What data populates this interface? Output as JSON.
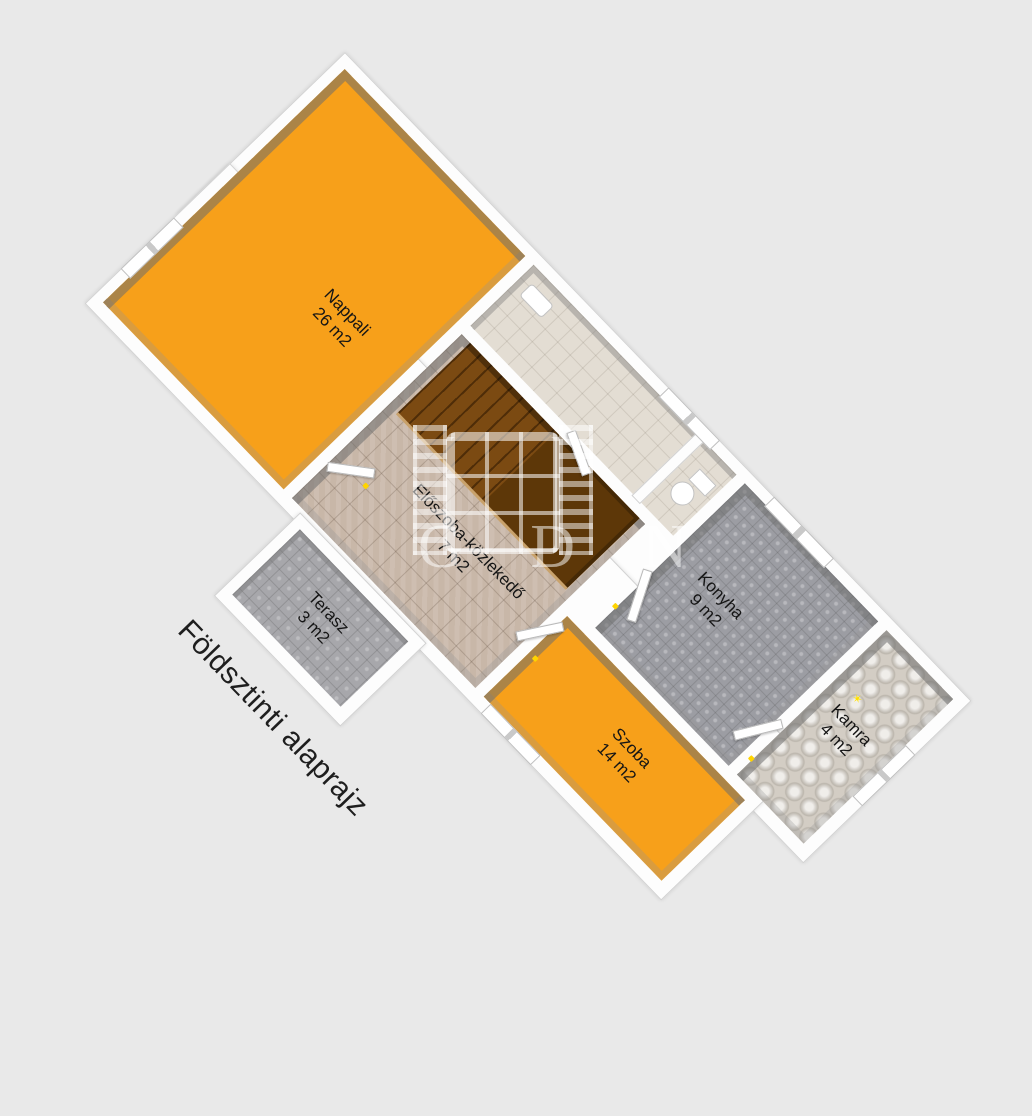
{
  "title": "Földsztinti alaprajz",
  "watermark": {
    "letters": "G D N"
  },
  "rooms": {
    "nappali": {
      "name": "Nappali",
      "area": "26 m2"
    },
    "eloszoba": {
      "name": "Előszoba-közlekedő",
      "area": "7 m2"
    },
    "konyha": {
      "name": "Konyha",
      "area": "9 m2"
    },
    "szoba": {
      "name": "Szoba",
      "area": "14 m2"
    },
    "terasz": {
      "name": "Terasz",
      "area": "3 m2"
    },
    "kamra": {
      "name": "Kamra",
      "area": "4 m2"
    }
  },
  "colors": {
    "background": "#e9e9e9",
    "floor_orange": "#F7A01A",
    "floor_tan": "#c8b7a8",
    "floor_gray": "#9c9da3",
    "floor_kamra": "#d3cdc4",
    "stairs_brown": "#7b4a12",
    "wall_white": "#fdfdfd",
    "wall_inner_gray": "#a6a6a6",
    "label_text": "#151515"
  }
}
